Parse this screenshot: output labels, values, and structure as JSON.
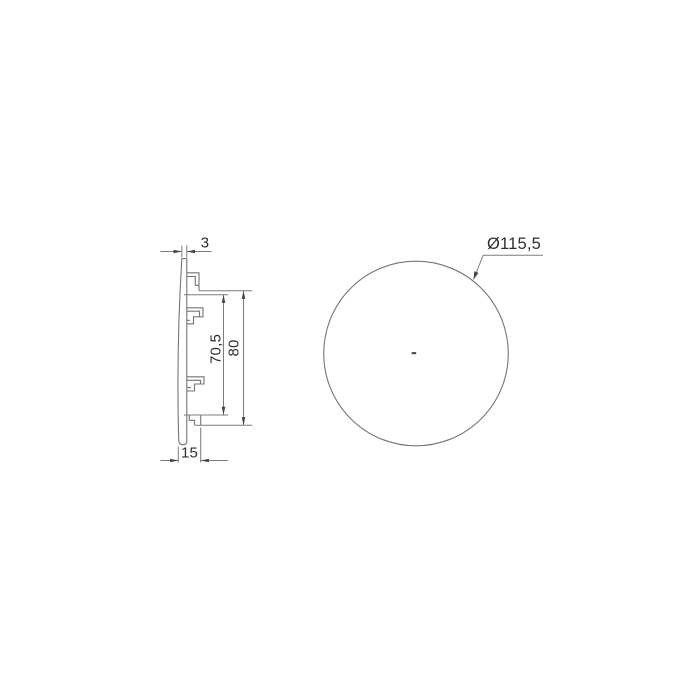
{
  "page": {
    "background": "#ffffff"
  },
  "palette": {
    "line": "#757575",
    "text": "#2e2e2e",
    "arrow": "#454545"
  },
  "side_view": {
    "name": "side-profile-view",
    "dims": {
      "thickness": "3",
      "inner_height": "70,5",
      "outer_height": "80",
      "depth": "15"
    }
  },
  "front_view": {
    "name": "front-circle-view",
    "dims": {
      "diameter": "Ø115,5"
    }
  }
}
